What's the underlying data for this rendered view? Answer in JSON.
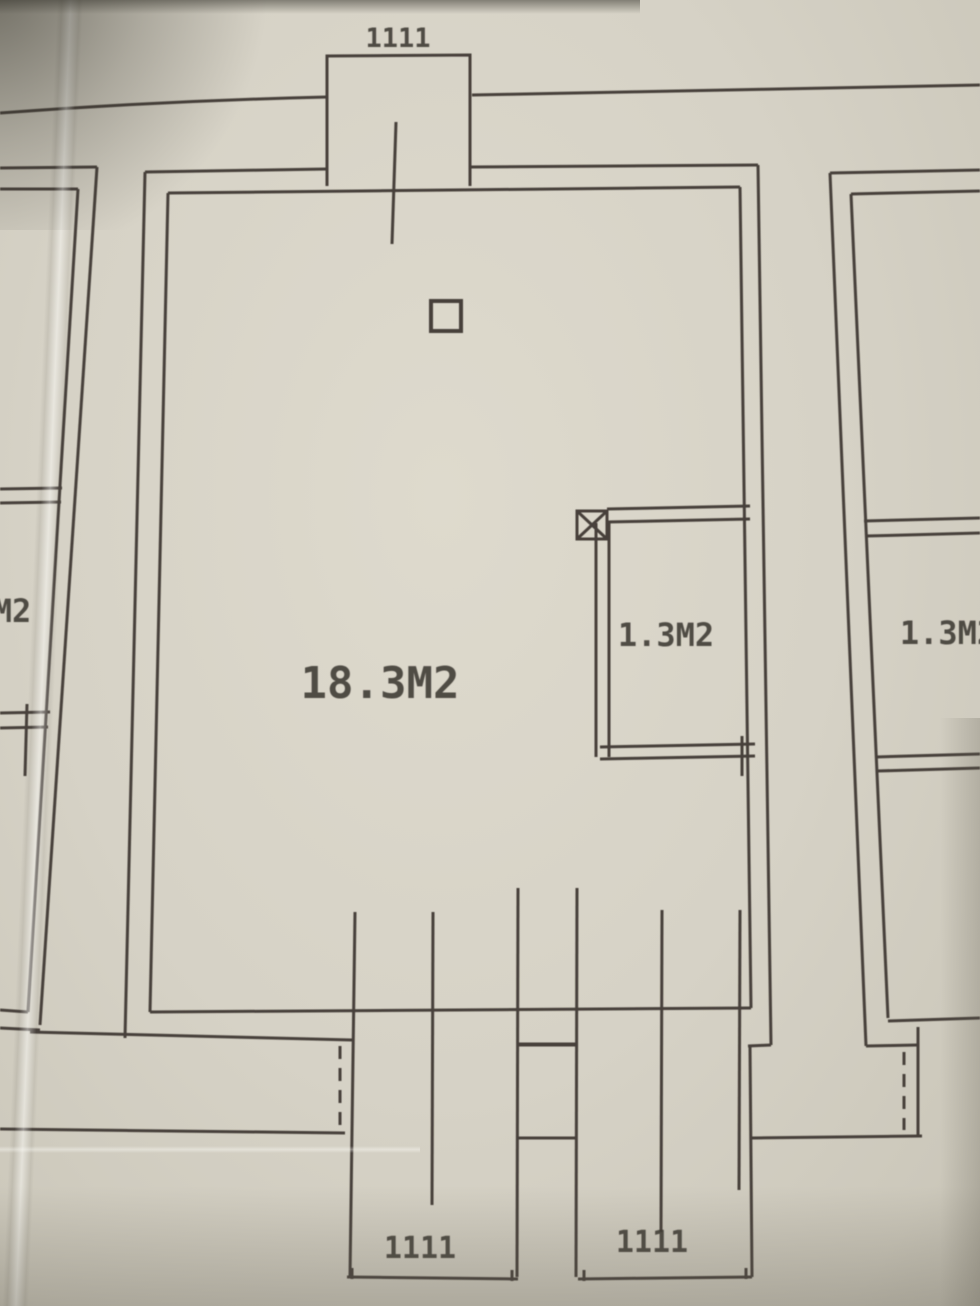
{
  "photo": {
    "paper_color": "#d6d2c6",
    "line_color": "#46413a",
    "text_color": "#3c3833"
  },
  "floor_plan": {
    "main_room": {
      "area_label": "18.3M2"
    },
    "closet": {
      "area_label": "1.3M2"
    },
    "right_apartment_room": {
      "area_label": "1.3M2"
    },
    "left_apartment_room": {
      "area_label_partial": "M2"
    },
    "dimensions": {
      "top_balcony": "1111",
      "bottom_left_balcony": "1111",
      "bottom_right_balcony": "1111"
    }
  }
}
